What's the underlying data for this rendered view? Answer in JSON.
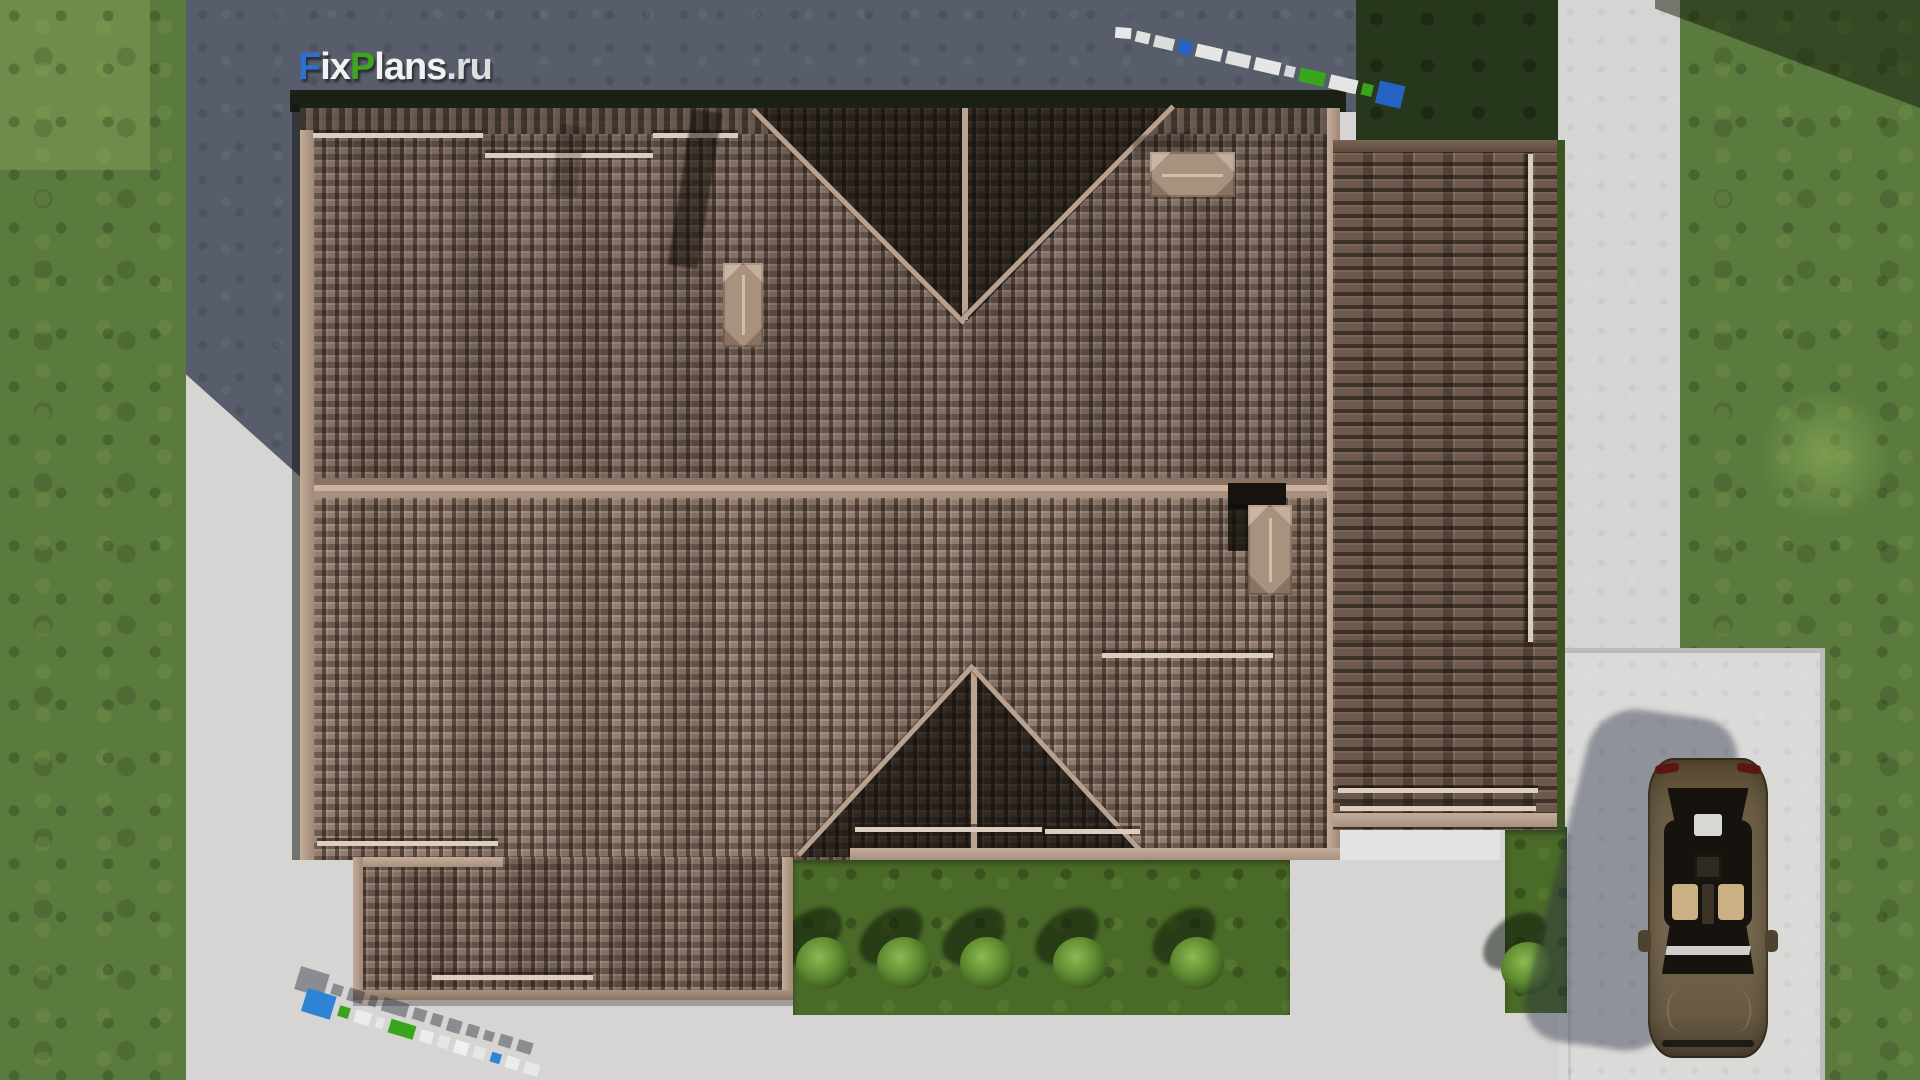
{
  "brand": {
    "name": "FixPlans.ru",
    "segments": [
      {
        "text": "F",
        "color": "#2e6fd0"
      },
      {
        "text": "ix",
        "color": "#f2f2f2"
      },
      {
        "text": "P",
        "color": "#3ea51d"
      },
      {
        "text": "lans",
        "color": "#f2f2f2"
      },
      {
        "text": ".ru",
        "color": "#dedede"
      }
    ]
  },
  "scene": {
    "type": "aerial-3d-architectural-render",
    "subject": "Top-down view of a house with brown tiled roof, lawn, concrete walkways, garden beds and a parked sedan",
    "roof": {
      "tile_color": "#8d7668",
      "ridge_color": "#b7a18f",
      "sections": [
        "main-upper-slope",
        "main-lower-slope",
        "top-gable-valley",
        "bottom-gable-valley",
        "right-wing",
        "bottom-left-wing"
      ],
      "skylight_count": 3,
      "snow_guard_count": 10
    },
    "landscape": {
      "grass_color": "#5a7a3e",
      "garden_bed_color": "#4a6a28",
      "bush_count": 6
    },
    "hardscape": {
      "pavement_color": "#d6d5d3",
      "shadow_color": "#575d6a",
      "patio": "bottom-right parking pad",
      "paths": "left strip, right path, bottom walkway"
    },
    "vehicle": {
      "type": "sedan-top-view",
      "body_color": "#6e6049",
      "location": "bottom-right parking pad"
    },
    "watermarks": {
      "top_left_logo": "FixPlans.ru",
      "top_right_strip": "FixPlans.ru angled ground watermark",
      "bottom_left_strip": "FixPlans.ru angled 3D ground watermark"
    }
  }
}
